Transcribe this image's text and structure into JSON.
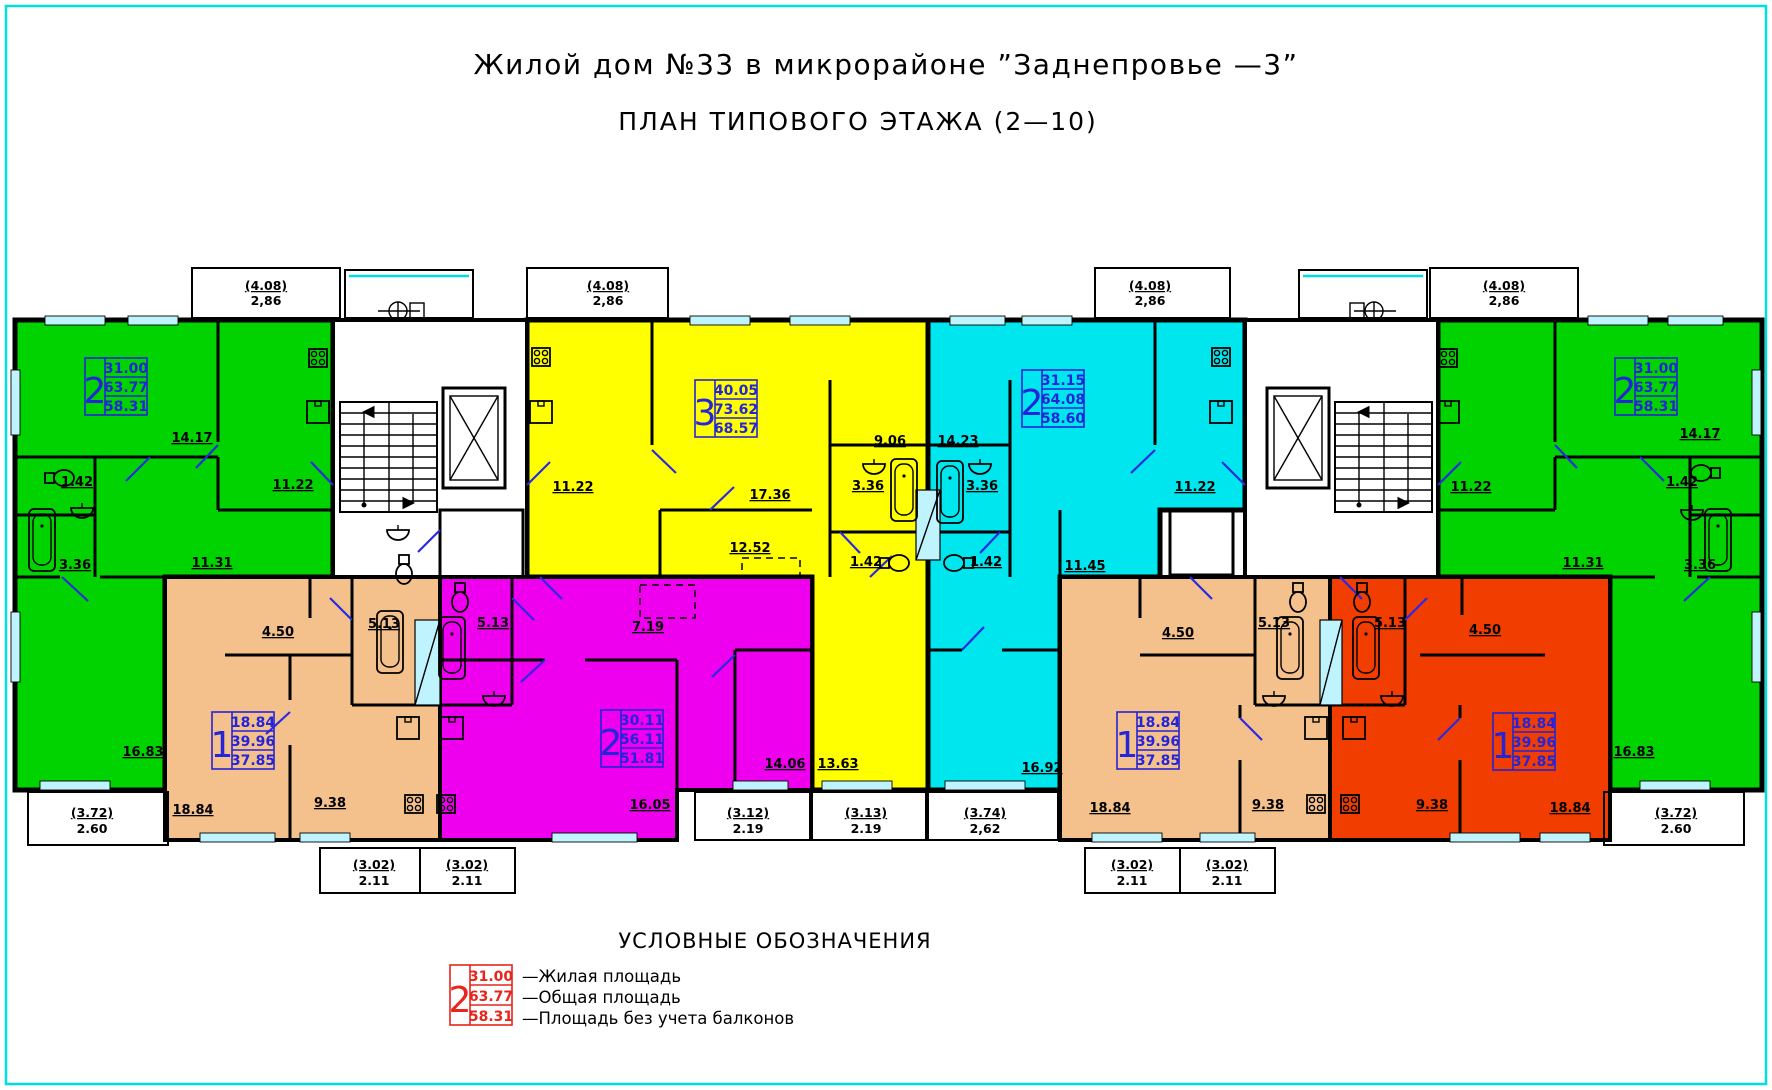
{
  "page": {
    "title": "Жилой дом №33 в микрорайоне ”Заднепровье —3”",
    "subtitle": "ПЛАН ТИПОВОГО ЭТАЖА (2—10)"
  },
  "colors": {
    "green": "#00d300",
    "yellow": "#ffff00",
    "cyan": "#00e6ef",
    "magenta": "#ee00ee",
    "tan": "#f4c08c",
    "orange": "#f23d00",
    "label_blue": "#2424d8",
    "legend_red": "#e8241c",
    "door_blue": "#2a2ae0",
    "window": "#bff4ff",
    "border_cyan": "#00dfdf",
    "wall": "#000000"
  },
  "legend": {
    "heading": "УСЛОВНЫЕ ОБОЗНАЧЕНИЯ",
    "sample": {
      "rooms": "2",
      "living": "31.00",
      "total": "63.77",
      "without": "58.31"
    },
    "living_label": "—Жилая площадь",
    "total_label": "—Общая площадь",
    "without_label": "—Площадь без учета балконов"
  },
  "apartments": {
    "green_left": {
      "rooms": "2",
      "living": "31.00",
      "total": "63.77",
      "without": "58.31",
      "dims": {
        "room1": "14.17",
        "kitchen": "11.22",
        "wc": "1.42",
        "bath": "3.36",
        "hall": "11.31",
        "room2": "16.83"
      },
      "balcony_top": {
        "area": "(4.08)",
        "size": "2,86"
      },
      "balcony_bottom": {
        "area": "(3.72)",
        "size": "2.60"
      }
    },
    "yellow": {
      "rooms": "3",
      "living": "40.05",
      "total": "73.62",
      "without": "68.57",
      "dims": {
        "kitchen": "11.22",
        "living_room": "17.36",
        "corridor": "9.06",
        "bath": "3.36",
        "wc": "1.42",
        "room2": "12.52",
        "room3": "13.63"
      },
      "balcony_top": {
        "area": "(4.08)",
        "size": "2,86"
      },
      "balcony_bottom": {
        "area": "(3.13)",
        "size": "2.19"
      }
    },
    "cyan": {
      "rooms": "2",
      "living": "31.15",
      "total": "64.08",
      "without": "58.60",
      "dims": {
        "living_room": "14.23",
        "bath": "3.36",
        "wc": "1.42",
        "kitchen": "11.22",
        "hall": "11.45",
        "room2": "16.92"
      },
      "balcony_top": {
        "area": "(4.08)",
        "size": "2,86"
      },
      "balcony_bottom": {
        "area": "(3.74)",
        "size": "2,62"
      }
    },
    "green_right": {
      "rooms": "2",
      "living": "31.00",
      "total": "63.77",
      "without": "58.31",
      "dims": {
        "room1": "14.17",
        "kitchen": "11.22",
        "wc": "1.42",
        "bath": "3.36",
        "hall": "11.31",
        "room2": "16.83"
      },
      "balcony_top": {
        "area": "(4.08)",
        "size": "2,86"
      },
      "balcony_bottom": {
        "area": "(3.72)",
        "size": "2.60"
      }
    },
    "tan_left": {
      "rooms": "1",
      "living": "18.84",
      "total": "39.96",
      "without": "37.85",
      "dims": {
        "hall": "4.50",
        "bath": "5.13",
        "room": "18.84",
        "kitchen": "9.38"
      },
      "balcony": {
        "area": "(3.02)",
        "size": "2.11"
      }
    },
    "magenta": {
      "rooms": "2",
      "living": "30.11",
      "total": "56.11",
      "without": "51.81",
      "dims": {
        "bath": "5.13",
        "hall": "7.19",
        "room1": "16.05",
        "room2": "14.06"
      },
      "balcony_side": {
        "area": "(3.12)",
        "size": "2.19"
      },
      "balcony_bottom": {
        "area": "(3.02)",
        "size": "2.11"
      }
    },
    "tan_right": {
      "rooms": "1",
      "living": "18.84",
      "total": "39.96",
      "without": "37.85",
      "dims": {
        "hall": "4.50",
        "bath": "5.13",
        "room": "18.84",
        "kitchen": "9.38"
      },
      "balcony": {
        "area": "(3.02)",
        "size": "2.11"
      }
    },
    "orange": {
      "rooms": "1",
      "living": "18.84",
      "total": "39.96",
      "without": "37.85",
      "dims": {
        "bath": "5.13",
        "hall": "4.50",
        "kitchen": "9.38",
        "room": "18.84"
      },
      "balcony": {
        "area": "(3.02)",
        "size": "2.11"
      }
    }
  }
}
